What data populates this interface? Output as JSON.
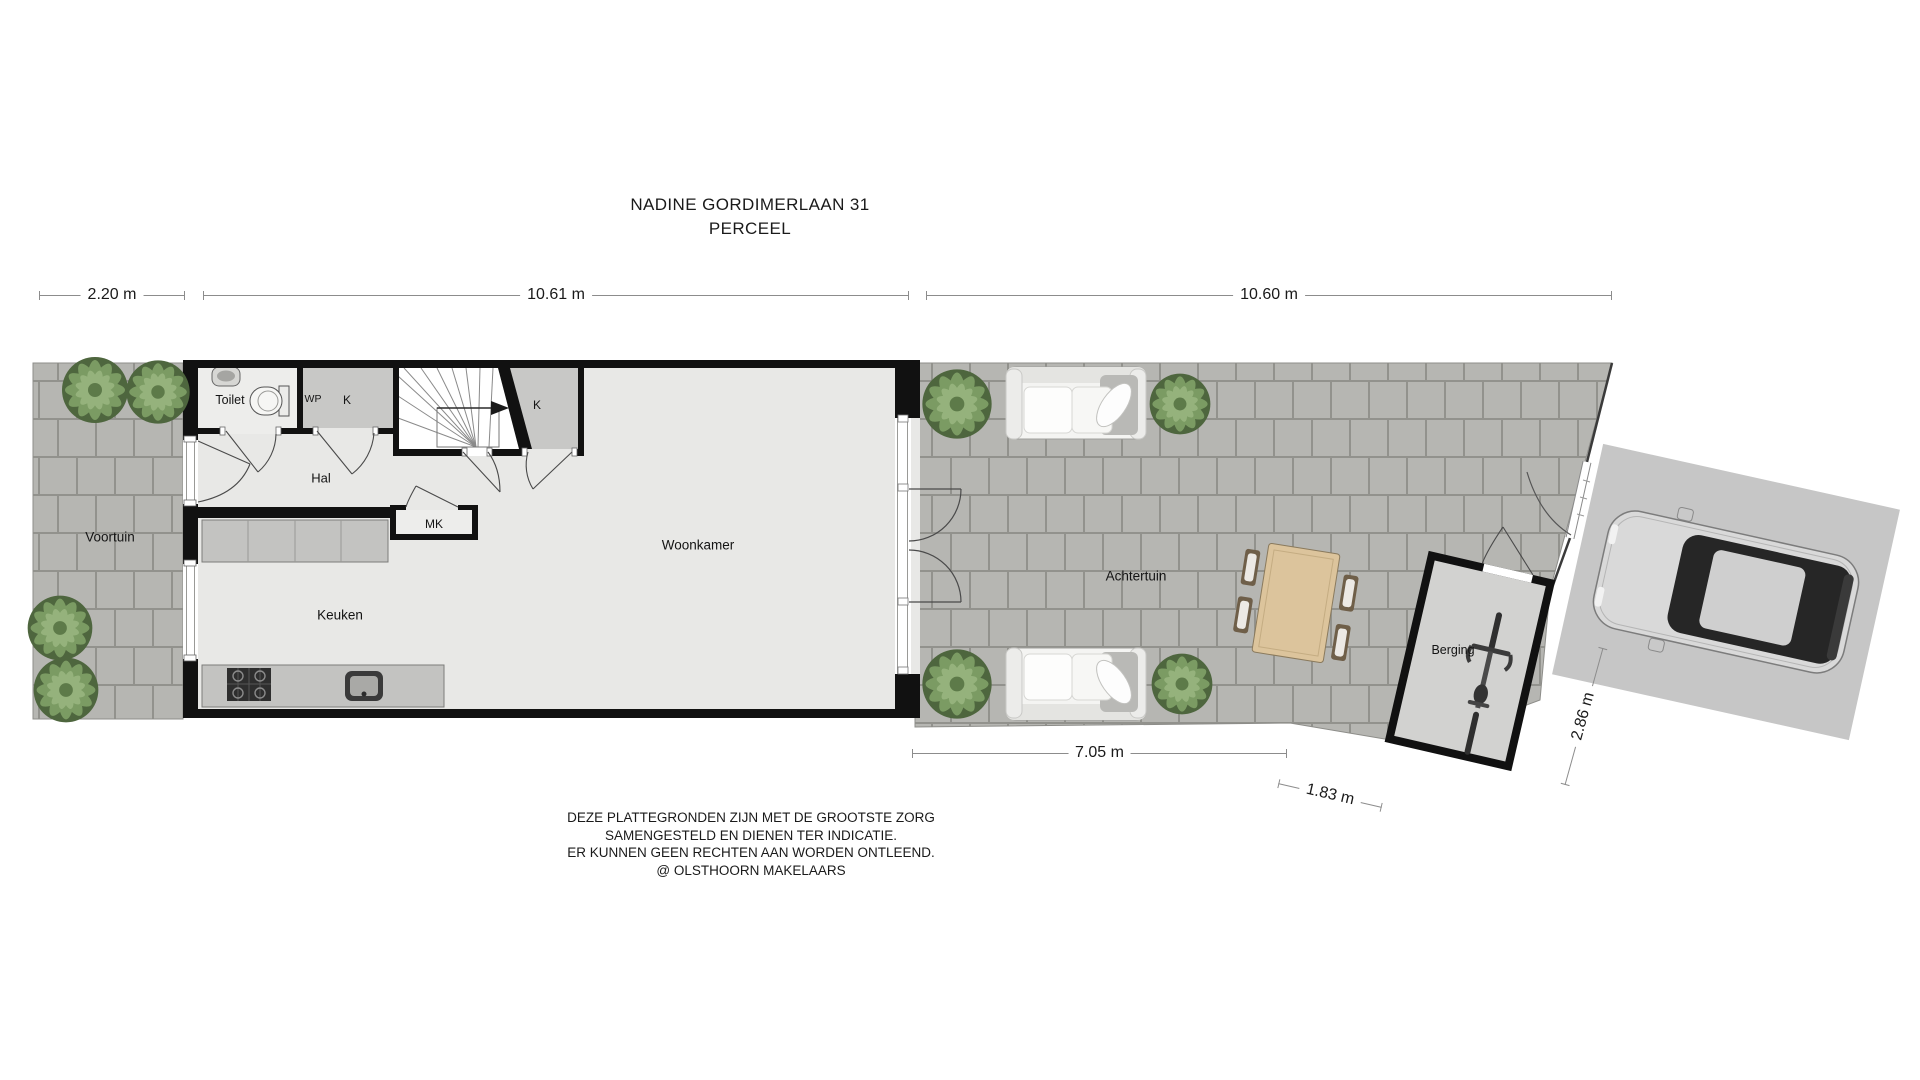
{
  "title": {
    "line1": "NADINE GORDIMERLAAN 31",
    "line2": "PERCEEL"
  },
  "dimensions": {
    "front_width": "2.20 m",
    "house_width": "10.61 m",
    "back_garden_width": "10.60 m",
    "back_garden_depth": "7.05 m",
    "shed_width": "1.83 m",
    "parking_width": "2.86 m"
  },
  "rooms": {
    "front_garden": "Voortuin",
    "toilet": "Toilet",
    "heat_pump_closet": "WP",
    "closet_left": "K",
    "closet_right": "K",
    "hallway": "Hal",
    "meter_closet": "MK",
    "kitchen": "Keuken",
    "living_room": "Woonkamer",
    "back_garden": "Achtertuin",
    "shed": "Berging"
  },
  "footer": {
    "line1": "DEZE PLATTEGRONDEN ZIJN MET DE GROOTSTE ZORG",
    "line2": "SAMENGESTELD EN DIENEN TER INDICATIE.",
    "line3": "ER KUNNEN GEEN RECHTEN AAN WORDEN ONTLEEND.",
    "line4": "@ OLSTHOORN MAKELAARS"
  },
  "icons": {
    "plant": "plant-icon",
    "sofa": "sofa-icon",
    "dining_table": "dining-table-icon",
    "car": "car-icon",
    "bicycle": "bicycle-icon",
    "toilet": "toilet-icon",
    "washbasin": "washbasin-icon",
    "stove": "stove-icon",
    "sink": "sink-icon",
    "stairs": "stairs-icon",
    "stair_arrow": "stair-direction-arrow-icon"
  },
  "colors": {
    "wall": "#111111",
    "paver": "#b6b6b2",
    "paver_joint": "#92928d",
    "floor": "#e8e8e6",
    "closet": "#c8c8c6",
    "counter": "#c3c3c1",
    "wood": "#dcc49c",
    "plant_dark": "#4e663e",
    "plant_mid": "#7b9b63",
    "plant_light": "#95b27c",
    "dimension_line": "#8c8c8c"
  }
}
